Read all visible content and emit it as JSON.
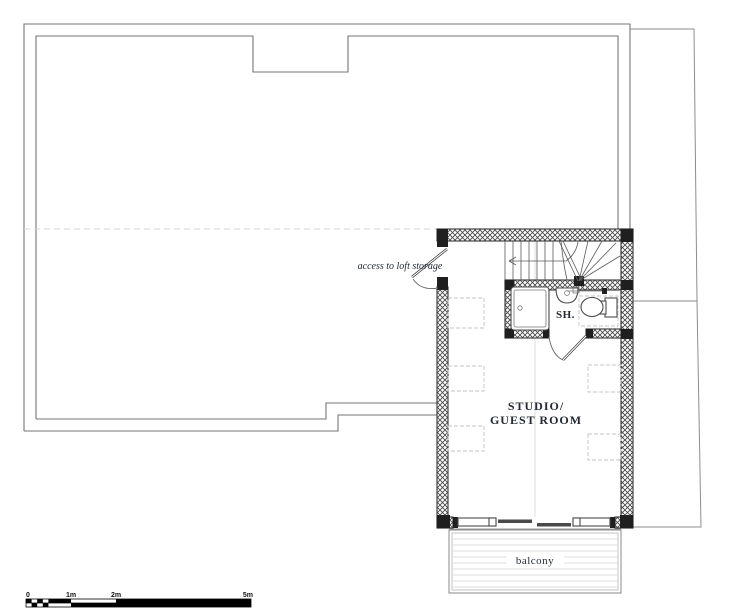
{
  "labels": {
    "loft_access": "access to loft storage",
    "shower": "SH.",
    "studio_line1": "STUDIO/",
    "studio_line2": "GUEST ROOM",
    "balcony": "balcony"
  },
  "scale_bar": {
    "ticks": [
      "0",
      "1m",
      "2m",
      "5m"
    ]
  },
  "colors": {
    "background": "#ffffff",
    "wall_line": "#333333",
    "wall_solid": "#1f1f1f",
    "roof_line": "#757575",
    "faint_line": "#d6d6d6",
    "fixture_line": "#4a4a4a",
    "label_text": "#232a35",
    "scale_text": "#111111"
  }
}
